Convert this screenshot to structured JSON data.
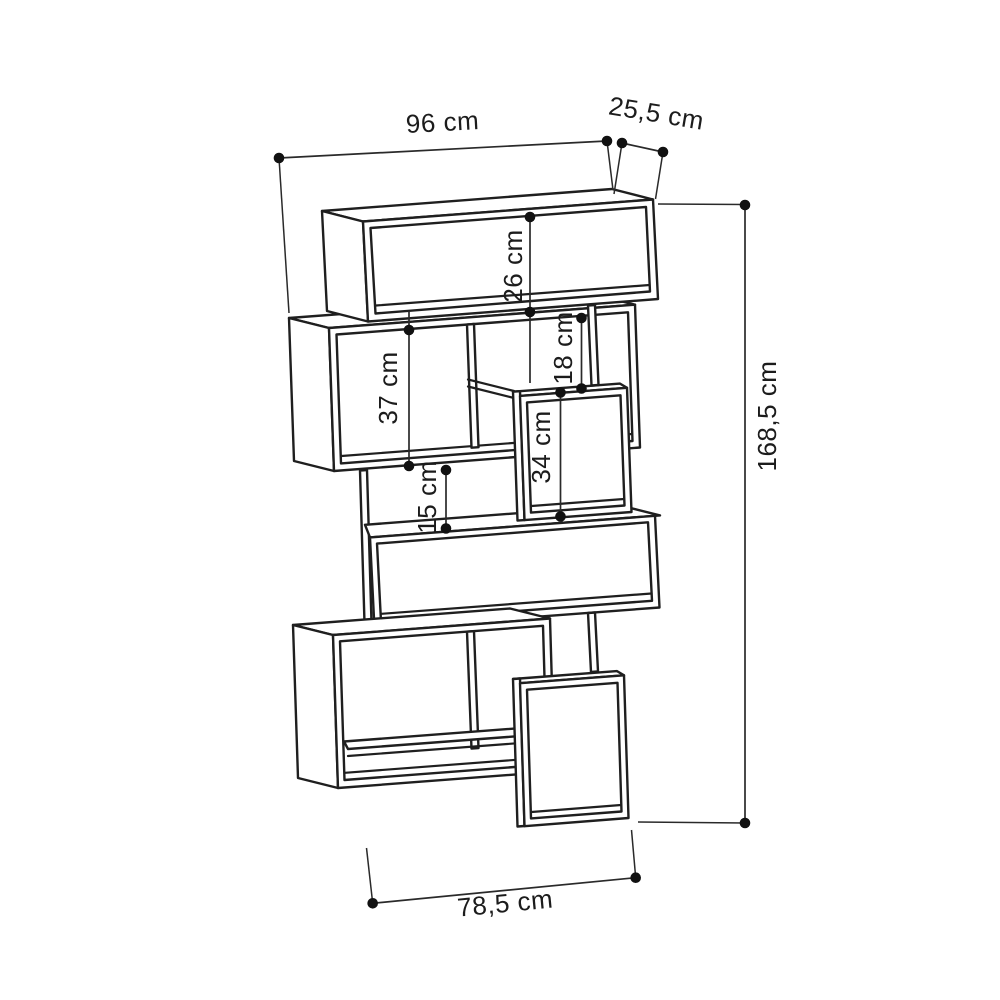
{
  "colors": {
    "line": "#1f1f1f",
    "dimension_line": "#2a2a2a",
    "background": "#ffffff"
  },
  "dimensions": {
    "overall_width": "96 cm",
    "depth": "25,5 cm",
    "top_compartment_height": "26 cm",
    "left_compartment_height": "37 cm",
    "upper_right_gap_height": "18 cm",
    "right_compartment_height": "34 cm",
    "middle_gap_height": "15 cm",
    "overall_height": "168,5 cm",
    "base_width": "78,5 cm"
  }
}
